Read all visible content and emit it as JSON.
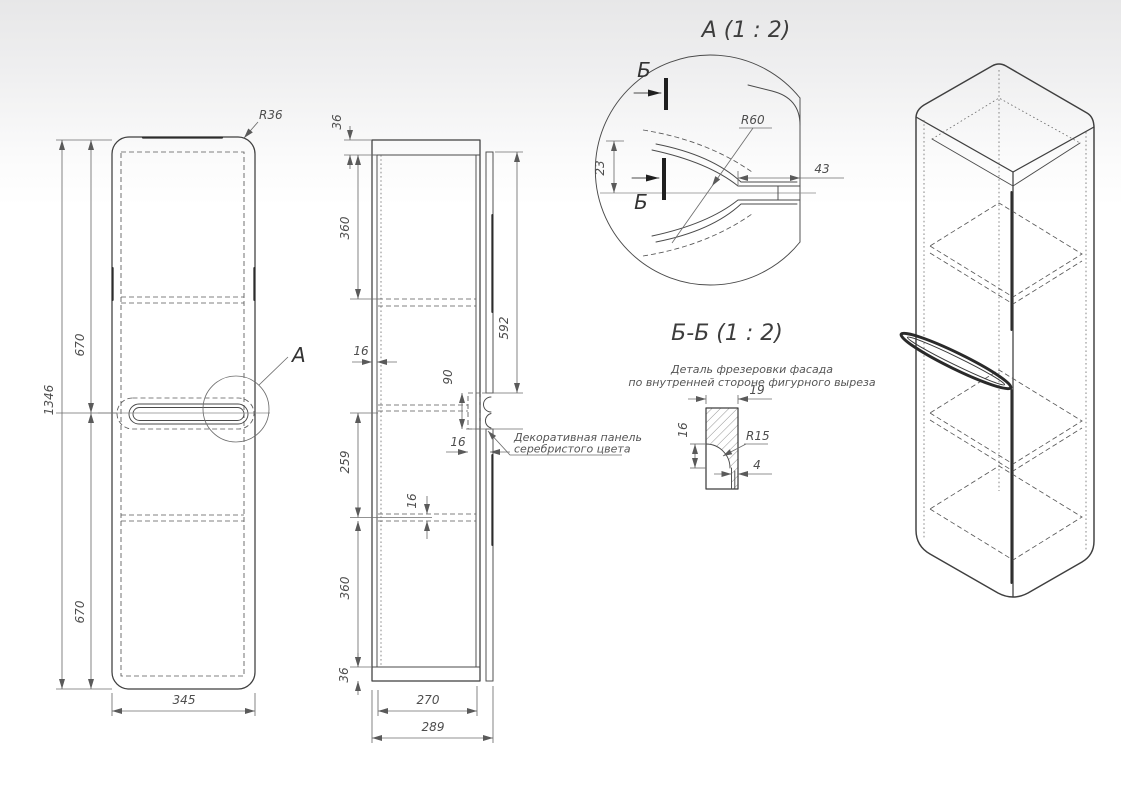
{
  "front_view": {
    "dims": {
      "total_height": "1346",
      "upper_section": "670",
      "lower_section": "670",
      "width": "345",
      "corner_radius": "R36"
    },
    "detail_label": "А"
  },
  "side_view": {
    "dims": {
      "top_panel": "36",
      "upper_section": "360",
      "facade_height": "592",
      "wall_thickness": "16",
      "handle_cutout": "90",
      "facade_thickness": "16",
      "middle_section": "259",
      "shelf_thickness": "16",
      "lower_section": "360",
      "bottom_panel": "36",
      "inner_width": "270",
      "depth": "289"
    },
    "annotation_line1": "Декоративная панель",
    "annotation_line2": "серебристого цвета"
  },
  "detail_a": {
    "title": "А  (1 : 2)",
    "section_label_top": "Б",
    "section_label_bottom": "Б",
    "dims": {
      "radius": "R60",
      "offset": "23",
      "slot_length": "43"
    }
  },
  "section_bb": {
    "title": "Б-Б  (1 : 2)",
    "note_line1": "Деталь фрезеровки фасада",
    "note_line2": "по внутренней стороне фигурного выреза",
    "dims": {
      "panel_thickness": "19",
      "mill_height": "16",
      "mill_radius": "R15",
      "lip_width": "4"
    }
  }
}
